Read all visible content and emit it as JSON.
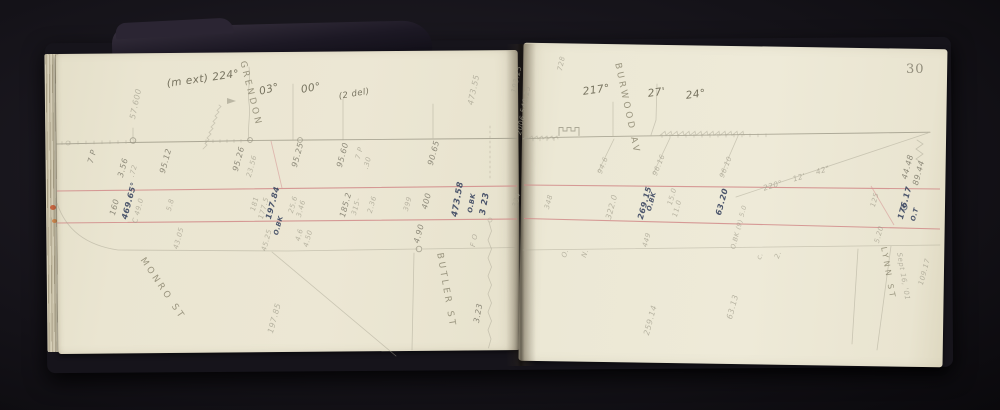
{
  "page_number": "30",
  "streets": {
    "grendon": "GRENDON",
    "burwood": "BURWOOD AV",
    "butler": "BUTLER ST",
    "monro": "MONRO ST",
    "lynn": "LYNN ST"
  },
  "angles": {
    "ext": "(m ext) 224°",
    "m03": "03°",
    "s00": "00°",
    "del": "(2 del)",
    "a217": "217°",
    "m27": "27'",
    "s24": "24°",
    "bearing": "220° 12' 42\""
  },
  "date": "Sept 16, '01",
  "ink": {
    "v46965": "469.65°",
    "v19784": "197.84",
    "v323": "3 23",
    "v47358": "473.58",
    "v26915": "269.15",
    "v6320": "63.20",
    "v17617": "176.17",
    "obk": "O.BK",
    "ot": "O.T"
  },
  "pencil": {
    "n5760": "57.600",
    "n47355": "473.55",
    "n19325": "193.25",
    "n54025": "540.25",
    "n2006": "2006",
    "n728": "728",
    "p7p": "7 P",
    "n356": "3.56",
    "n72": ".72",
    "n9512": "95.12",
    "n160": "160",
    "c490": "C 49.0",
    "n58": "5.8",
    "n9526": "95.26",
    "n2356": "23.56",
    "n9525": "95.25",
    "n9560": "95.60",
    "n30": ".30",
    "n9065": "90.65",
    "n181": "181",
    "n1775": "177.5",
    "n256": "25.6",
    "n346": "3.46",
    "n1852": "185.2",
    "n315": "315-",
    "n236": "2.36",
    "n399": "399",
    "n400": "400",
    "n334": "334",
    "n4305": "43.05",
    "n4525": "45.25",
    "n46": "4.6",
    "n450": "4.50",
    "n490": "4.90",
    "fo": "F O",
    "n323": "3.23",
    "n19785": "197.85",
    "n348": "348",
    "n3220": "322.0",
    "n150": "15.0",
    "n110": "11.0",
    "obk9": "O.BK (9) 5.0",
    "n946": "94.6",
    "n9616": "96.16",
    "n9610": "96.10",
    "n4448": "44.48",
    "n8944": "89.44",
    "n125": "125",
    "n520": "5.20",
    "lo": "O.",
    "ln": "N.",
    "n449": "449",
    "lc": "c.",
    "l2": "2.",
    "n25914": "259.14",
    "n6313": "63.13",
    "n10917": "109.17"
  },
  "colors": {
    "backdrop": "#0a090d",
    "cover": "#16141b",
    "page": "#ece8d5",
    "pencil": "#8e8a7a",
    "ink_blue": "#3e4963",
    "red_rule": "#d08484",
    "edge_fleck": "#c4552e"
  }
}
